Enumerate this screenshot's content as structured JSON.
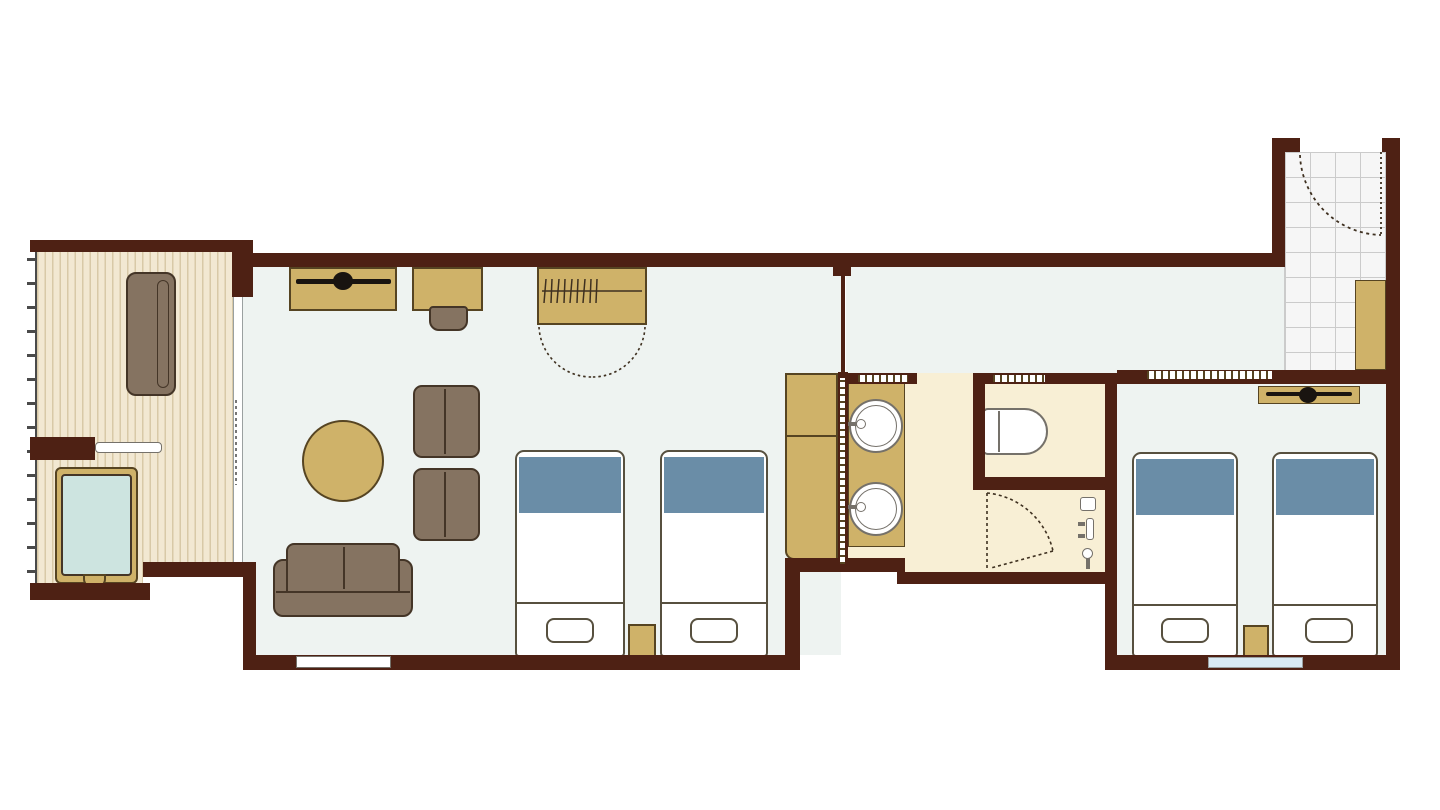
{
  "document": {
    "type": "floor-plan",
    "title": "Hotel guest room floor plan",
    "visible_text": []
  },
  "palette": {
    "bg": "#ffffff",
    "wall": "#4e2114",
    "floor-main": "#eef3f1",
    "floor-deck": "#f2e8d2",
    "deck-stripe": "#d8c9a7",
    "floor-bath": "#f8efd5",
    "floor-tile": "#f6f6f6",
    "tile-line": "#cbcbcb",
    "tan": "#cfb269",
    "tan-border": "#564422",
    "brown": "#857361",
    "brown-border": "#443527",
    "bed-blue": "#6a8da7",
    "bed-border": "#57503f",
    "water": "#cde4e0",
    "window-blue": "#d9eaf4",
    "black": "#191410",
    "white": "#ffffff",
    "fixture-border": "#75716a",
    "glass-line": "#9aa0a0",
    "rail": "#4a4a4a",
    "symbol-line": "#3e3020"
  },
  "rooms": [
    {
      "name": "balcony-deck",
      "features": [
        "deck-railing",
        "outdoor-bench",
        "outdoor-bathtub",
        "tub-step",
        "sliding-glass-door"
      ]
    },
    {
      "name": "living-bedroom",
      "features": [
        "tv-console",
        "tv-symbol",
        "desk",
        "desk-chair",
        "wardrobe-with-hangers",
        "wardrobe-double-door-swing",
        "round-table",
        "armchair",
        "armchair",
        "sofa",
        "twin-bed",
        "twin-bed",
        "nightstand",
        "minibar-cabinet",
        "window"
      ]
    },
    {
      "name": "washroom",
      "features": [
        "pocket-sliding-door",
        "vanity-counter",
        "washbasin",
        "washbasin",
        "faucet",
        "faucet",
        "door-swing",
        "shower-fixtures"
      ]
    },
    {
      "name": "toilet-room",
      "features": [
        "toilet",
        "sliding-door"
      ]
    },
    {
      "name": "corridor",
      "features": [
        "thin-partition-wall"
      ]
    },
    {
      "name": "entry",
      "features": [
        "tiled-floor",
        "entry-door-swing",
        "shoe-cabinet"
      ]
    },
    {
      "name": "second-bedroom",
      "features": [
        "sliding-door",
        "tv-console",
        "tv-symbol",
        "twin-bed",
        "twin-bed",
        "nightstand",
        "window"
      ]
    }
  ]
}
